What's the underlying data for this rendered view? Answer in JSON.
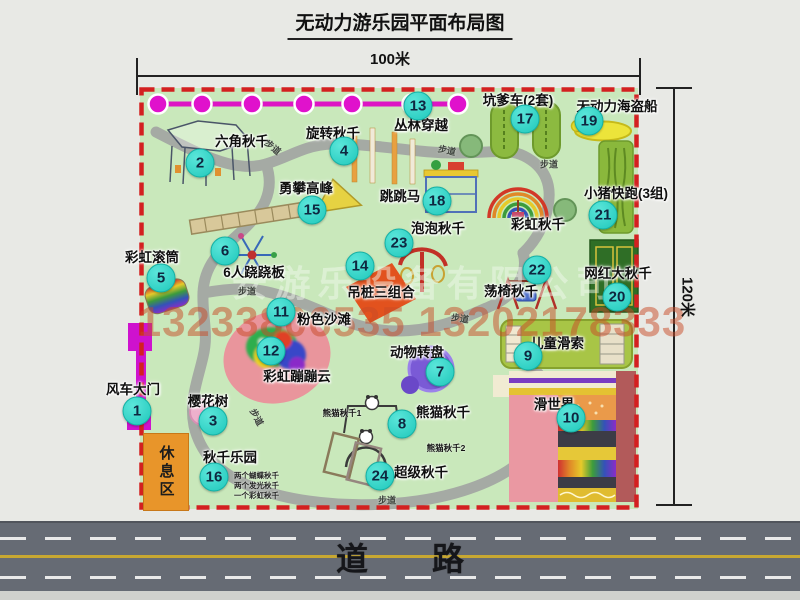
{
  "title": "无动力游乐园平面布局图",
  "dimension_top": "100米",
  "dimension_right": "120米",
  "road": {
    "label": "道　　路"
  },
  "watermark": {
    "company": "安游乐设备有限公司",
    "phone": "13233806535 13202178333",
    "phone_color": "#c74926"
  },
  "map": {
    "rest_area": "休息区",
    "walkway_text": "步道",
    "colors": {
      "badge": "#1fc8bb",
      "border_dashed": "#d32020",
      "grass": "#c9e8bb",
      "path": "#a5aaa4",
      "jungle_line": "#dd14c4",
      "road": "#666b74",
      "rest_area": "#e8952a"
    },
    "walkway_labels": [
      {
        "x": 273,
        "y": 147,
        "rot": 40
      },
      {
        "x": 447,
        "y": 150,
        "rot": 12
      },
      {
        "x": 549,
        "y": 164,
        "rot": 0
      },
      {
        "x": 247,
        "y": 291,
        "rot": 0
      },
      {
        "x": 460,
        "y": 318,
        "rot": 8
      },
      {
        "x": 257,
        "y": 417,
        "rot": 62
      },
      {
        "x": 387,
        "y": 500,
        "rot": 0
      }
    ],
    "attractions": [
      {
        "num": 1,
        "name": "风车大门",
        "bx": 137,
        "by": 411,
        "lx": 133,
        "ly": 388
      },
      {
        "num": 2,
        "name": "六角秋千",
        "bx": 200,
        "by": 163,
        "lx": 242,
        "ly": 140
      },
      {
        "num": 3,
        "name": "樱花树",
        "bx": 213,
        "by": 421,
        "lx": 208,
        "ly": 400
      },
      {
        "num": 4,
        "name": "旋转秋千",
        "bx": 344,
        "by": 151,
        "lx": 333,
        "ly": 132
      },
      {
        "num": 5,
        "name": "彩虹滚筒",
        "bx": 161,
        "by": 278,
        "lx": 152,
        "ly": 256
      },
      {
        "num": 6,
        "name": "6人跷跷板",
        "bx": 225,
        "by": 251,
        "lx": 254,
        "ly": 271
      },
      {
        "num": 7,
        "name": "动物转盘",
        "bx": 440,
        "by": 372,
        "lx": 417,
        "ly": 351
      },
      {
        "num": 8,
        "name": "熊猫秋千",
        "bx": 402,
        "by": 424,
        "lx": 443,
        "ly": 411
      },
      {
        "num": 9,
        "name": "儿童滑索",
        "bx": 528,
        "by": 356,
        "lx": 557,
        "ly": 342
      },
      {
        "num": 10,
        "name": "滑世界",
        "bx": 571,
        "by": 418,
        "lx": 554,
        "ly": 403
      },
      {
        "num": 11,
        "name": "粉色沙滩",
        "bx": 281,
        "by": 312,
        "lx": 324,
        "ly": 318
      },
      {
        "num": 12,
        "name": "彩虹蹦蹦云",
        "bx": 271,
        "by": 351,
        "lx": 297,
        "ly": 375
      },
      {
        "num": 13,
        "name": "丛林穿越",
        "bx": 418,
        "by": 106,
        "lx": 421,
        "ly": 124
      },
      {
        "num": 14,
        "name": "吊桩三组合",
        "bx": 360,
        "by": 266,
        "lx": 381,
        "ly": 291
      },
      {
        "num": 15,
        "name": "勇攀高峰",
        "bx": 312,
        "by": 210,
        "lx": 306,
        "ly": 187
      },
      {
        "num": 16,
        "name": "秋千乐园",
        "bx": 214,
        "by": 477,
        "lx": 230,
        "ly": 456
      },
      {
        "num": 17,
        "name": "坑爹车(2套)",
        "bx": 525,
        "by": 119,
        "lx": 518,
        "ly": 99
      },
      {
        "num": 18,
        "name": "跳跳马",
        "bx": 437,
        "by": 201,
        "lx": 400,
        "ly": 195
      },
      {
        "num": 19,
        "name": "无动力海盗船",
        "bx": 589,
        "by": 121,
        "lx": 617,
        "ly": 105
      },
      {
        "num": 20,
        "name": "网红大秋千",
        "bx": 617,
        "by": 297,
        "lx": 618,
        "ly": 272
      },
      {
        "num": 21,
        "name": "小猪快跑(3组)",
        "bx": 603,
        "by": 215,
        "lx": 626,
        "ly": 192
      },
      {
        "num": 22,
        "name": "荡椅秋千",
        "bx": 537,
        "by": 270,
        "lx": 511,
        "ly": 290
      },
      {
        "num": 23,
        "name": "泡泡秋千",
        "bx": 399,
        "by": 243,
        "lx": 438,
        "ly": 227
      },
      {
        "num": 24,
        "name": "超级秋千",
        "bx": 380,
        "by": 476,
        "lx": 421,
        "ly": 471
      }
    ],
    "rainbow_swing_label": {
      "text": "彩虹秋千",
      "x": 538,
      "y": 223
    },
    "small_labels": [
      {
        "text": "熊猫秋千1",
        "x": 342,
        "y": 413
      },
      {
        "text": "熊猫秋千2",
        "x": 446,
        "y": 448
      }
    ],
    "swing_park_notes": [
      "两个蝴蝶秋千",
      "两个发光秋千",
      "一个彩虹秋千"
    ]
  }
}
